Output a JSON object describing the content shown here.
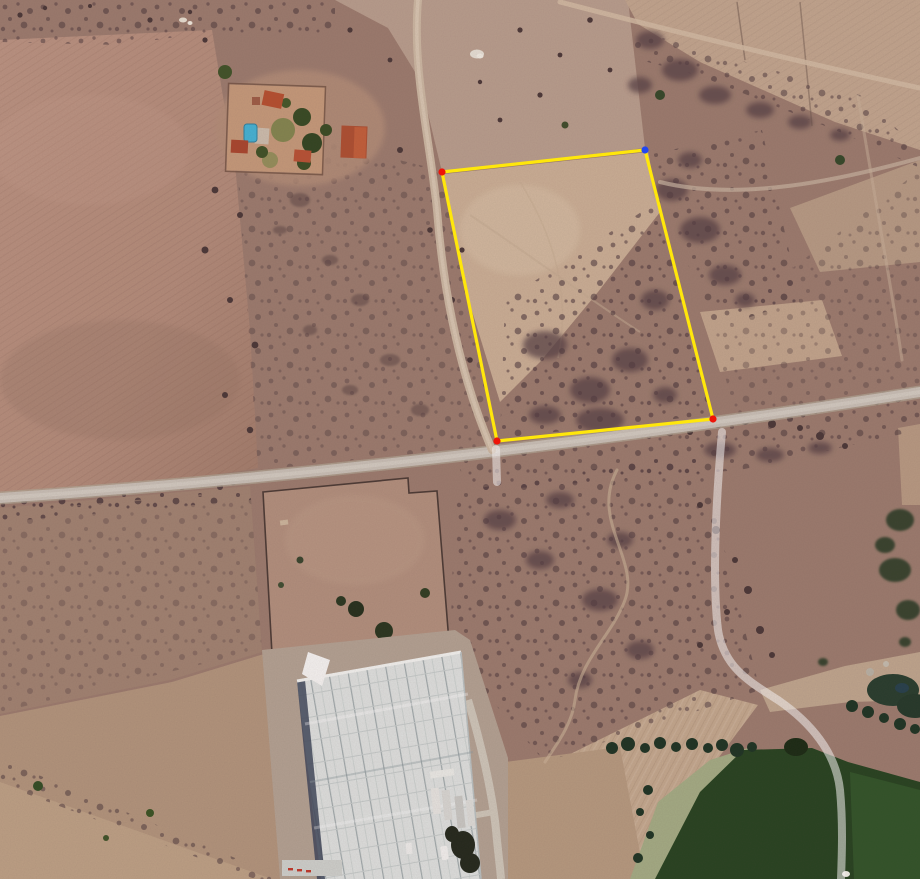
{
  "view": {
    "kind": "satellite-imagery",
    "width": 920,
    "height": 879
  },
  "annotation": {
    "polygon": {
      "stroke_color": "#ffe70b",
      "stroke_width": 3.2,
      "fill": "none",
      "marker_radius": 3.6,
      "vertices": [
        {
          "id": "nw",
          "x": 442,
          "y": 172,
          "marker_color": "#ee1408"
        },
        {
          "id": "ne",
          "x": 645,
          "y": 150,
          "marker_color": "#2147f2"
        },
        {
          "id": "se",
          "x": 713,
          "y": 419,
          "marker_color": "#ee1408"
        },
        {
          "id": "sw",
          "x": 497,
          "y": 441,
          "marker_color": "#ee1408"
        }
      ]
    },
    "route_track": {
      "color": "#ffffff",
      "opacity": 0.55,
      "width": 8
    }
  },
  "palette": {
    "terrain_scrub": "#9a7b6d",
    "plowed_field": "#b68f7d",
    "bare_soil": "#cfb49a",
    "road": "#c9c2b8",
    "dirt_road": "#cdb9a2",
    "greenhouse_roof": "#dfe4e2",
    "crop_dark_green": "#20401c",
    "crop_light_green": "#2e5626",
    "pool_blue": "#3fb4d8",
    "roof_red": "#b04a2c"
  }
}
